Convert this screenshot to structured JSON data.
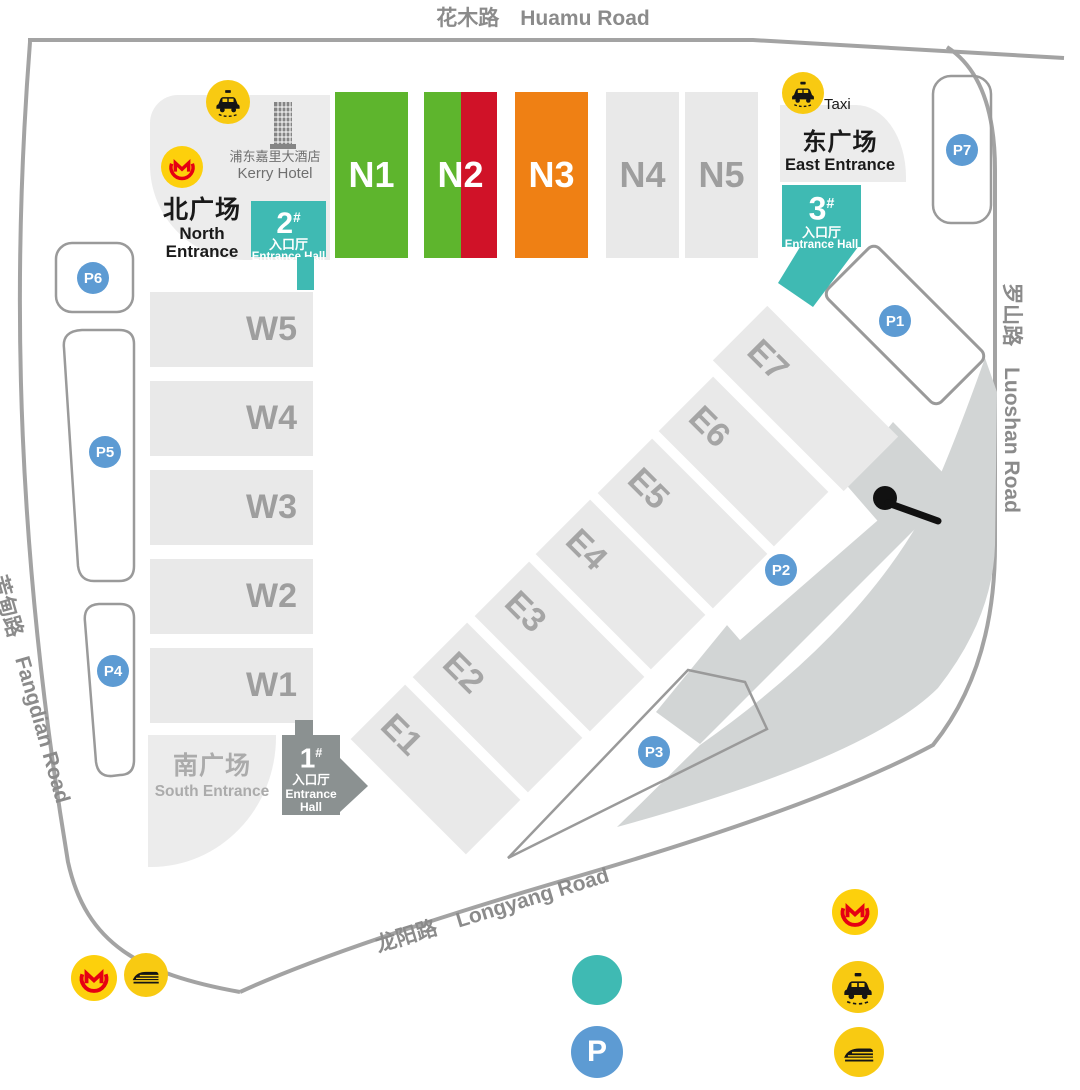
{
  "roads": {
    "huamu": "花木路　Huamu Road",
    "luoshan": "罗山路　Luoshan Road",
    "fangdian": "芳甸路　Fangdian Road",
    "longyang": "龙阳路　Longyang Road"
  },
  "halls": {
    "north": [
      {
        "label": "N1"
      },
      {
        "label": "N2"
      },
      {
        "label": "N3"
      },
      {
        "label": "N4"
      },
      {
        "label": "N5"
      }
    ],
    "west": [
      {
        "label": "W5"
      },
      {
        "label": "W4"
      },
      {
        "label": "W3"
      },
      {
        "label": "W2"
      },
      {
        "label": "W1"
      }
    ],
    "east": [
      {
        "label": "E1"
      },
      {
        "label": "E2"
      },
      {
        "label": "E3"
      },
      {
        "label": "E4"
      },
      {
        "label": "E5"
      },
      {
        "label": "E6"
      },
      {
        "label": "E7"
      }
    ]
  },
  "entrances": {
    "north": {
      "cn": "北广场",
      "en_line1": "North",
      "en_line2": "Entrance"
    },
    "east": {
      "cn": "东广场",
      "en": "East Entrance"
    },
    "south": {
      "cn": "南广场",
      "en": "South Entrance"
    }
  },
  "entrance_halls": {
    "h1": {
      "num": "1",
      "sup": "#",
      "cn": "入口厅",
      "en_line1": "Entrance",
      "en_line2": "Hall"
    },
    "h2": {
      "num": "2",
      "sup": "#",
      "cn": "入口厅",
      "en": "Entrance Hall"
    },
    "h3": {
      "num": "3",
      "sup": "#",
      "cn": "入口厅",
      "en": "Entrance Hall"
    }
  },
  "landmarks": {
    "hotel_cn": "浦东嘉里大酒店",
    "hotel_en": "Kerry Hotel",
    "taxi_label": "Taxi"
  },
  "parking": {
    "p1": "P1",
    "p2": "P2",
    "p3": "P3",
    "p4": "P4",
    "p5": "P5",
    "p6": "P6",
    "p7": "P7",
    "legend_p": "P"
  },
  "colors": {
    "hall_gray": "#e9e9e9",
    "hall_label_gray": "#9e9e9e",
    "green": "#5eb52d",
    "red": "#d01228",
    "orange": "#ef8014",
    "teal": "#3fbab3",
    "entry_gray": "#8b9191",
    "parking_blue": "#5d9bd3",
    "icon_yellow": "#f8ca12",
    "metro_red": "#e60012",
    "road_line": "#a3a3a3",
    "road_text": "#8b8b8b"
  }
}
